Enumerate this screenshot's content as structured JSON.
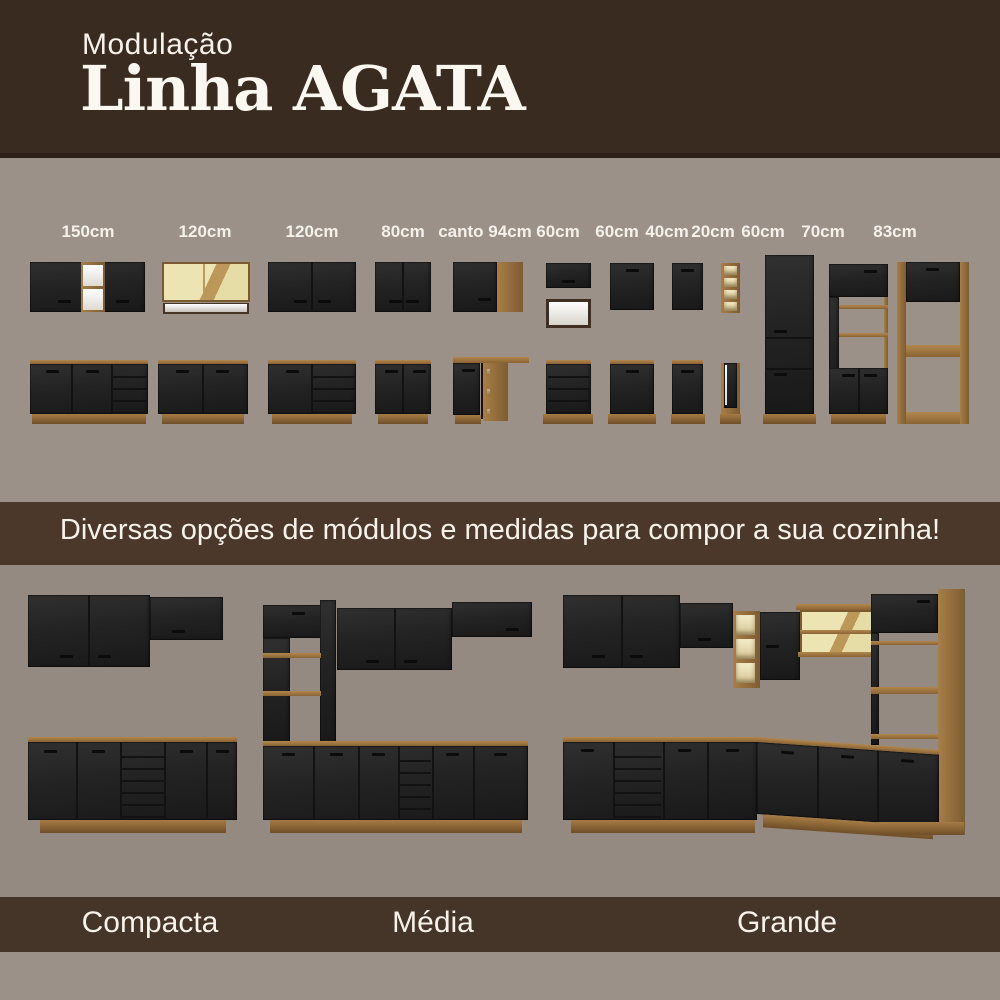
{
  "header": {
    "kicker": "Modulação",
    "title": "Linha AGATA"
  },
  "modules": {
    "labels": [
      "150cm",
      "120cm",
      "120cm",
      "80cm",
      "canto 94cm",
      "60cm",
      "60cm",
      "40cm",
      "20cm",
      "60cm",
      "70cm",
      "83cm"
    ]
  },
  "banner": {
    "text": "Diversas opções de módulos e medidas para compor a sua cozinha!"
  },
  "kitchens": [
    {
      "name": "Compacta"
    },
    {
      "name": "Média"
    },
    {
      "name": "Grande"
    }
  ],
  "colors": {
    "brown_header": "#3a2b21",
    "brown_banner": "#4c382a",
    "brown_footer": "#453428",
    "gray_modules": "#9b9189",
    "gray_kitchens": "#948a82",
    "cabinet_black": "#232323",
    "wood": "#a07944",
    "wood_dark": "#6f4f28",
    "glass_cream": "#e9e0ab",
    "niche_white": "#f2efe9",
    "text_white": "#f7f3ec"
  }
}
